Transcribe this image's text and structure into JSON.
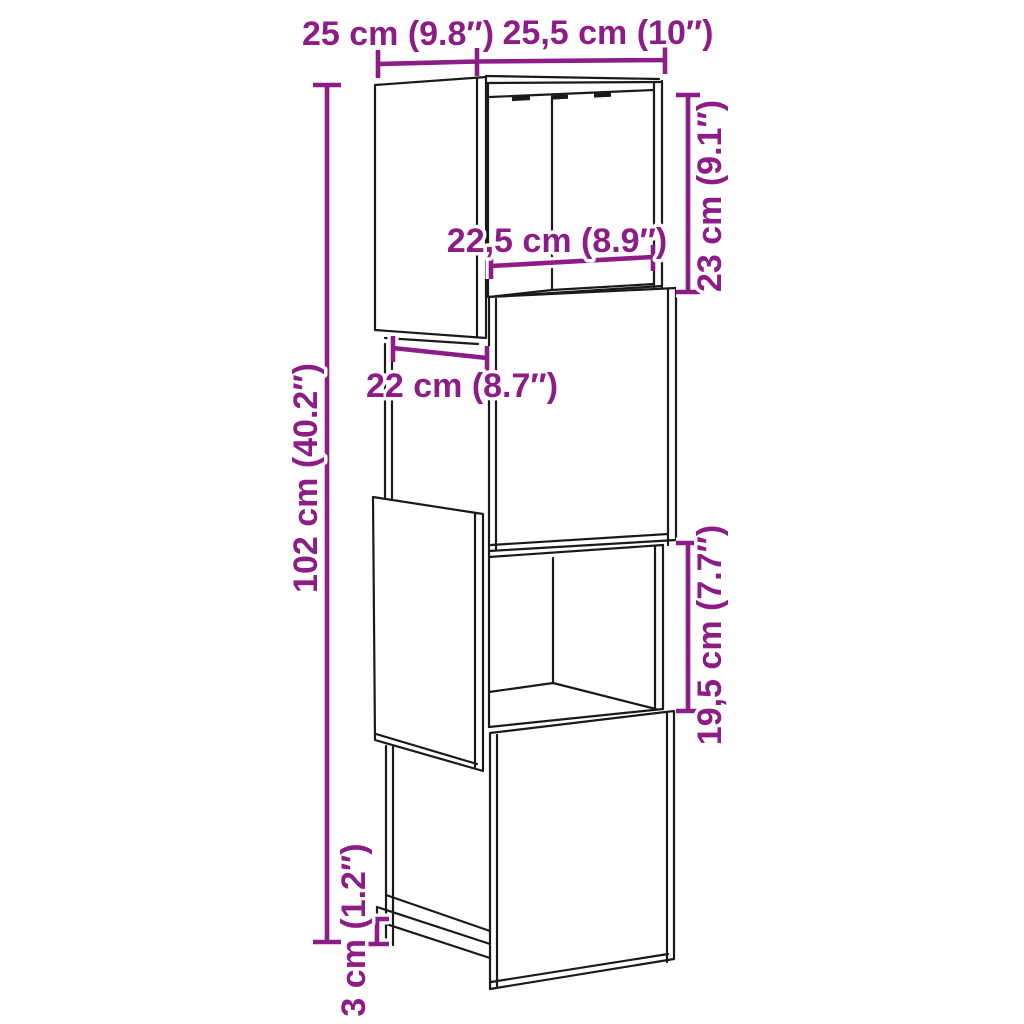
{
  "diagram": {
    "kind": "furniture-dimension-line-drawing",
    "subject": "staggered 4-cube cabinet / shelving unit"
  },
  "colors": {
    "accent": "#8C1D86",
    "line": "#1A1A1A",
    "background": "#FFFFFF"
  },
  "dimensions": {
    "top_left": {
      "cm": "25",
      "inch": "9.8",
      "label": "25 cm (9.8″)"
    },
    "top_right": {
      "cm": "25,5",
      "inch": "10",
      "label": "25,5 cm (10″)"
    },
    "right_upper": {
      "cm": "23",
      "inch": "9.1",
      "label": "23 cm (9.1″)"
    },
    "inner_width_upper": {
      "cm": "22,5",
      "inch": "8.9",
      "label": "22,5 cm (8.9″)"
    },
    "inner_width_lower": {
      "cm": "22",
      "inch": "8.7",
      "label": "22 cm (8.7″)"
    },
    "left_height": {
      "cm": "102",
      "inch": "40.2",
      "label": "102 cm (40.2″)"
    },
    "right_lower": {
      "cm": "19,5",
      "inch": "7.7",
      "label": "19,5 cm (7.7″)"
    },
    "bottom_left": {
      "cm": "3",
      "inch": "1.2",
      "label": "3 cm (1.2″)"
    }
  }
}
